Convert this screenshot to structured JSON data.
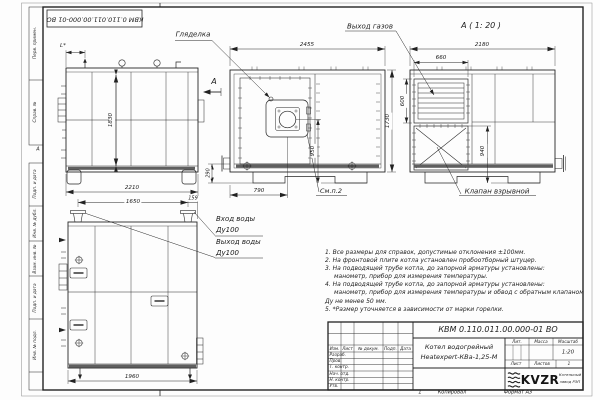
{
  "frame": {
    "top_designation": "КВМ 0.110.011.00.000-01 ВО",
    "zone_letter": "А",
    "margin_labels_top": [
      "Перв. примен.",
      "Справ. №"
    ],
    "margin_labels_bottom": [
      "Подп. и дата",
      "Инв. № дубл.",
      "Взам. инв. №",
      "Подп. и дата",
      "Инв. № подл."
    ]
  },
  "views": {
    "side": {
      "dim_height": "1830",
      "dim_width": "2210",
      "dim_top": "L*",
      "view_arrow": "А"
    },
    "front": {
      "dim_width": "2455",
      "dim_height": "1730",
      "dim_burner_x": "790",
      "dim_burner_y": "950",
      "dim_base": "290",
      "label_sight_glass": "Гляделка",
      "label_see_note": "См.п.2"
    },
    "rear": {
      "view_title": "А ( 1: 20 )",
      "dim_width": "2180",
      "dim_louver_width": "660",
      "dim_louver_height": "600",
      "dim_valve_height": "940",
      "label_gas_outlet": "Выход газов",
      "label_explosion_valve": "Клапан взрывной"
    },
    "side_bottom": {
      "dim_pipe_spacing": "1650",
      "dim_pipe_offset": "159",
      "dim_width": "1960",
      "label_water_inlet": "Вход воды",
      "label_water_inlet_dn": "Ду100",
      "label_water_outlet": "Выход воды",
      "label_water_outlet_dn": "Ду100"
    }
  },
  "notes": {
    "lines": [
      "1. Все размеры для справок, допустимые отклонения ±100мм.",
      "2. На фронтовой плите котла установлен пробоотборный штуцер.",
      "3. На подводящей трубе котла, до запорной арматуры установлены:",
      "манометр, прибор для измерения температуры.",
      "4. На подводящей трубе котла, до запорной арматуры установлены:",
      "манометр, прибор для измерения температуры и обвод с обратным клапаном",
      "Ду не менее 50 мм.",
      "5. *Размер уточняется в зависимости от марки горелки."
    ]
  },
  "title_block": {
    "designation": "КВМ 0.110.011.00.000-01 ВО",
    "product_name_line1": "Котел водогрейный",
    "product_name_line2": "Heatexpert-КВа-1,25-М",
    "columns": {
      "izm": "Изм.",
      "list": "Лист",
      "doc": "№ докум.",
      "sign": "Подп.",
      "date": "Дата"
    },
    "rows": [
      "Разраб.",
      "Пров.",
      "Т. контр.",
      "Нач. отд.",
      "Н. контр.",
      "Утв."
    ],
    "lit_label": "Лит.",
    "mass_label": "Масса",
    "scale_label": "Масштаб",
    "scale_value": "1:20",
    "sheet_label": "Лист",
    "sheets_label": "Листов",
    "sheets_value": "1",
    "logo_text": "KVZR",
    "logo_caption_line1": "Котельный",
    "logo_caption_line2": "завод РЭП",
    "footer_num": "1",
    "footer_copied": "Копировал",
    "footer_format": "Формат А3"
  }
}
